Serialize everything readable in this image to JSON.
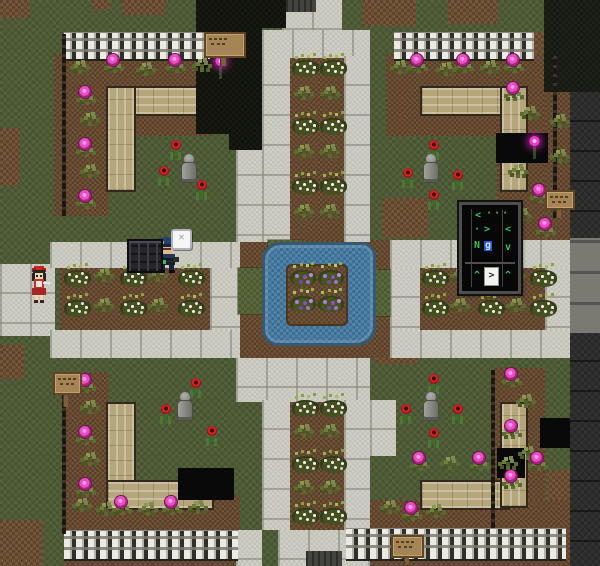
{
  "scene": {
    "title": "park-plaza-garden-map",
    "width": 600,
    "height": 566
  },
  "terrain": {
    "dirt_patches": [
      [
        0,
        0,
        30,
        18
      ],
      [
        92,
        0,
        18,
        10
      ],
      [
        122,
        0,
        44,
        15
      ],
      [
        362,
        0,
        54,
        26
      ],
      [
        448,
        0,
        50,
        24
      ],
      [
        532,
        32,
        12,
        58
      ],
      [
        0,
        128,
        20,
        58
      ],
      [
        382,
        198,
        46,
        40
      ],
      [
        0,
        345,
        24,
        34
      ],
      [
        212,
        334,
        30,
        24
      ],
      [
        376,
        336,
        42,
        28
      ],
      [
        0,
        520,
        42,
        46
      ],
      [
        204,
        544,
        34,
        22
      ],
      [
        546,
        470,
        24,
        54
      ]
    ],
    "beds": [
      [
        54,
        54,
        156,
        82
      ],
      [
        54,
        54,
        54,
        162
      ],
      [
        386,
        54,
        158,
        82
      ],
      [
        497,
        54,
        48,
        190
      ],
      [
        545,
        90,
        30,
        150
      ],
      [
        64,
        372,
        44,
        160
      ],
      [
        64,
        495,
        176,
        71
      ],
      [
        495,
        368,
        50,
        164
      ],
      [
        340,
        500,
        230,
        66
      ],
      [
        290,
        56,
        54,
        186
      ],
      [
        290,
        400,
        54,
        130
      ],
      [
        60,
        268,
        150,
        62
      ],
      [
        420,
        268,
        125,
        62
      ],
      [
        236,
        240,
        154,
        118
      ]
    ],
    "stones": [
      [
        282,
        0,
        60,
        32
      ],
      [
        262,
        30,
        108,
        28
      ],
      [
        236,
        56,
        26,
        186
      ],
      [
        262,
        56,
        28,
        186
      ],
      [
        344,
        56,
        26,
        186
      ],
      [
        0,
        264,
        55,
        72
      ],
      [
        50,
        242,
        190,
        26
      ],
      [
        50,
        330,
        190,
        28
      ],
      [
        210,
        268,
        30,
        62
      ],
      [
        390,
        240,
        180,
        28
      ],
      [
        390,
        268,
        30,
        62
      ],
      [
        545,
        268,
        25,
        62
      ],
      [
        390,
        330,
        180,
        28
      ],
      [
        236,
        358,
        134,
        44
      ],
      [
        262,
        400,
        28,
        130
      ],
      [
        344,
        400,
        26,
        130
      ],
      [
        370,
        400,
        26,
        56
      ],
      [
        278,
        530,
        92,
        36
      ],
      [
        236,
        530,
        26,
        36
      ]
    ],
    "grass_accents": [
      [
        268,
        240,
        34,
        8
      ],
      [
        238,
        268,
        24,
        46
      ],
      [
        372,
        270,
        18,
        46
      ]
    ],
    "dark_regions": [
      [
        196,
        0,
        66,
        134
      ],
      [
        229,
        134,
        33,
        16
      ],
      [
        262,
        0,
        24,
        28
      ],
      [
        496,
        133,
        52,
        30
      ],
      [
        178,
        468,
        56,
        32
      ],
      [
        497,
        448,
        28,
        30
      ],
      [
        540,
        418,
        30,
        30
      ]
    ],
    "doorways": [
      [
        286,
        0,
        30,
        12
      ],
      [
        306,
        551,
        36,
        15
      ]
    ],
    "wall": {
      "column": [
        570,
        0,
        30,
        566
      ],
      "corner": [
        544,
        0,
        56,
        92
      ],
      "blocks": [
        570,
        238,
        30,
        95
      ]
    }
  },
  "water": {
    "pond": [
      262,
      242,
      108,
      98
    ],
    "island": [
      286,
      264,
      58,
      58
    ]
  },
  "fences": [
    [
      64,
      32,
      146,
      26
    ],
    [
      394,
      32,
      140,
      26
    ],
    [
      64,
      530,
      174,
      28
    ],
    [
      346,
      528,
      220,
      30
    ]
  ],
  "poles": [
    [
      62,
      34,
      4,
      182
    ],
    [
      553,
      56,
      4,
      162
    ],
    [
      62,
      376,
      4,
      158
    ],
    [
      491,
      370,
      4,
      158
    ]
  ],
  "benches": [
    {
      "o": "h",
      "r": [
        106,
        86,
        104,
        26
      ]
    },
    {
      "o": "v",
      "r": [
        106,
        86,
        26,
        102
      ]
    },
    {
      "o": "h",
      "r": [
        420,
        86,
        86,
        26
      ]
    },
    {
      "o": "v",
      "r": [
        500,
        86,
        24,
        102
      ]
    },
    {
      "o": "v",
      "r": [
        106,
        402,
        26,
        102
      ]
    },
    {
      "o": "h",
      "r": [
        106,
        480,
        104,
        26
      ]
    },
    {
      "o": "h",
      "r": [
        420,
        480,
        86,
        26
      ]
    },
    {
      "o": "v",
      "r": [
        500,
        402,
        24,
        102
      ]
    }
  ],
  "signs": [
    {
      "board": [
        204,
        32,
        38,
        22
      ],
      "post": [
        220,
        54,
        5,
        12
      ]
    },
    {
      "board": [
        545,
        190,
        26,
        16
      ],
      "post": [
        556,
        206,
        4,
        12
      ]
    },
    {
      "board": [
        53,
        372,
        25,
        19
      ],
      "post": [
        63,
        391,
        4,
        16
      ]
    },
    {
      "board": [
        391,
        535,
        29,
        19
      ],
      "post": [
        404,
        554,
        4,
        10
      ]
    }
  ],
  "statues": [
    [
      180,
      154
    ],
    [
      422,
      154
    ],
    [
      176,
      392
    ],
    [
      422,
      392
    ]
  ],
  "plants": [
    [
      "t",
      70,
      66
    ],
    [
      "p",
      104,
      60
    ],
    [
      "t",
      136,
      68
    ],
    [
      "p",
      166,
      60
    ],
    [
      "t",
      192,
      64
    ],
    [
      "p",
      76,
      92
    ],
    [
      "t",
      80,
      118
    ],
    [
      "p",
      76,
      144
    ],
    [
      "t",
      80,
      170
    ],
    [
      "p",
      76,
      196
    ],
    [
      "t",
      390,
      66
    ],
    [
      "p",
      408,
      60
    ],
    [
      "t",
      436,
      68
    ],
    [
      "p",
      454,
      60
    ],
    [
      "t",
      480,
      66
    ],
    [
      "p",
      504,
      60
    ],
    [
      "p",
      504,
      88
    ],
    [
      "t",
      520,
      112
    ],
    [
      "t",
      508,
      170
    ],
    [
      "p",
      530,
      190
    ],
    [
      "t",
      512,
      214
    ],
    [
      "p",
      536,
      224
    ],
    [
      "t",
      550,
      120
    ],
    [
      "t",
      550,
      155
    ],
    [
      "p",
      76,
      380
    ],
    [
      "t",
      80,
      406
    ],
    [
      "p",
      76,
      432
    ],
    [
      "t",
      80,
      458
    ],
    [
      "p",
      76,
      484
    ],
    [
      "t",
      72,
      504
    ],
    [
      "t",
      96,
      508
    ],
    [
      "p",
      112,
      502
    ],
    [
      "t",
      138,
      508
    ],
    [
      "p",
      162,
      502
    ],
    [
      "t",
      188,
      506
    ],
    [
      "p",
      502,
      374
    ],
    [
      "t",
      516,
      400
    ],
    [
      "p",
      502,
      426
    ],
    [
      "t",
      518,
      452
    ],
    [
      "p",
      502,
      476
    ],
    [
      "p",
      410,
      458
    ],
    [
      "t",
      440,
      462
    ],
    [
      "p",
      470,
      458
    ],
    [
      "t",
      498,
      462
    ],
    [
      "p",
      528,
      458
    ],
    [
      "t",
      380,
      506
    ],
    [
      "p",
      402,
      508
    ],
    [
      "t",
      426,
      510
    ],
    [
      "b",
      292,
      60
    ],
    [
      "b",
      320,
      60
    ],
    [
      "t",
      294,
      92
    ],
    [
      "t",
      320,
      92
    ],
    [
      "b",
      292,
      118
    ],
    [
      "b",
      320,
      118
    ],
    [
      "t",
      294,
      150
    ],
    [
      "t",
      320,
      150
    ],
    [
      "b",
      292,
      178
    ],
    [
      "b",
      320,
      178
    ],
    [
      "t",
      294,
      210
    ],
    [
      "t",
      320,
      210
    ],
    [
      "b",
      292,
      400
    ],
    [
      "b",
      320,
      400
    ],
    [
      "t",
      294,
      430
    ],
    [
      "t",
      320,
      430
    ],
    [
      "b",
      292,
      456
    ],
    [
      "b",
      320,
      456
    ],
    [
      "t",
      294,
      486
    ],
    [
      "t",
      320,
      486
    ],
    [
      "b",
      292,
      508
    ],
    [
      "b",
      320,
      508
    ],
    [
      "b",
      64,
      270
    ],
    [
      "t",
      94,
      274
    ],
    [
      "b",
      120,
      270
    ],
    [
      "t",
      148,
      274
    ],
    [
      "b",
      178,
      270
    ],
    [
      "b",
      64,
      300
    ],
    [
      "t",
      94,
      304
    ],
    [
      "b",
      120,
      300
    ],
    [
      "t",
      148,
      304
    ],
    [
      "b",
      178,
      300
    ],
    [
      "b",
      422,
      270
    ],
    [
      "t",
      450,
      274
    ],
    [
      "b",
      478,
      270
    ],
    [
      "t",
      506,
      274
    ],
    [
      "b",
      530,
      270
    ],
    [
      "b",
      422,
      300
    ],
    [
      "t",
      450,
      304
    ],
    [
      "b",
      478,
      300
    ],
    [
      "t",
      506,
      304
    ],
    [
      "b",
      530,
      300
    ],
    [
      "u",
      290,
      270
    ],
    [
      "u",
      318,
      270
    ],
    [
      "u",
      290,
      296
    ],
    [
      "u",
      318,
      296
    ],
    [
      "r",
      170,
      140
    ],
    [
      "r",
      158,
      166
    ],
    [
      "r",
      196,
      180
    ],
    [
      "r",
      428,
      140
    ],
    [
      "r",
      402,
      168
    ],
    [
      "r",
      452,
      170
    ],
    [
      "r",
      428,
      190
    ],
    [
      "r",
      190,
      378
    ],
    [
      "r",
      160,
      404
    ],
    [
      "r",
      206,
      426
    ],
    [
      "r",
      428,
      374
    ],
    [
      "r",
      400,
      404
    ],
    [
      "r",
      452,
      404
    ],
    [
      "r",
      428,
      428
    ],
    [
      "g",
      214,
      56
    ],
    [
      "g",
      528,
      136
    ]
  ],
  "characters": {
    "girl": {
      "x": 27,
      "y": 264,
      "w": 24,
      "h": 40,
      "label": "girl in red dress"
    },
    "soldier": {
      "x": 150,
      "y": 236,
      "w": 34,
      "h": 38,
      "label": "soldier in blue uniform"
    }
  },
  "objects": {
    "crate": {
      "x": 127,
      "y": 239,
      "w": 32,
      "h": 30
    },
    "bubble_icon": {
      "x": 171,
      "y": 229,
      "w": 17,
      "h": 17,
      "glyph": "✕"
    }
  },
  "panel": {
    "x": 459,
    "y": 202,
    "w": 56,
    "h": 86,
    "green": "#35c94e",
    "line1_left": "<",
    "line1_right": "· · ·",
    "line2_left": "· >",
    "line2_right": "<",
    "line3_left": "N",
    "line3_sel": "g",
    "line3_right": "v",
    "line4_left": "^",
    "line4_mid": ">",
    "line4_right": "^"
  }
}
